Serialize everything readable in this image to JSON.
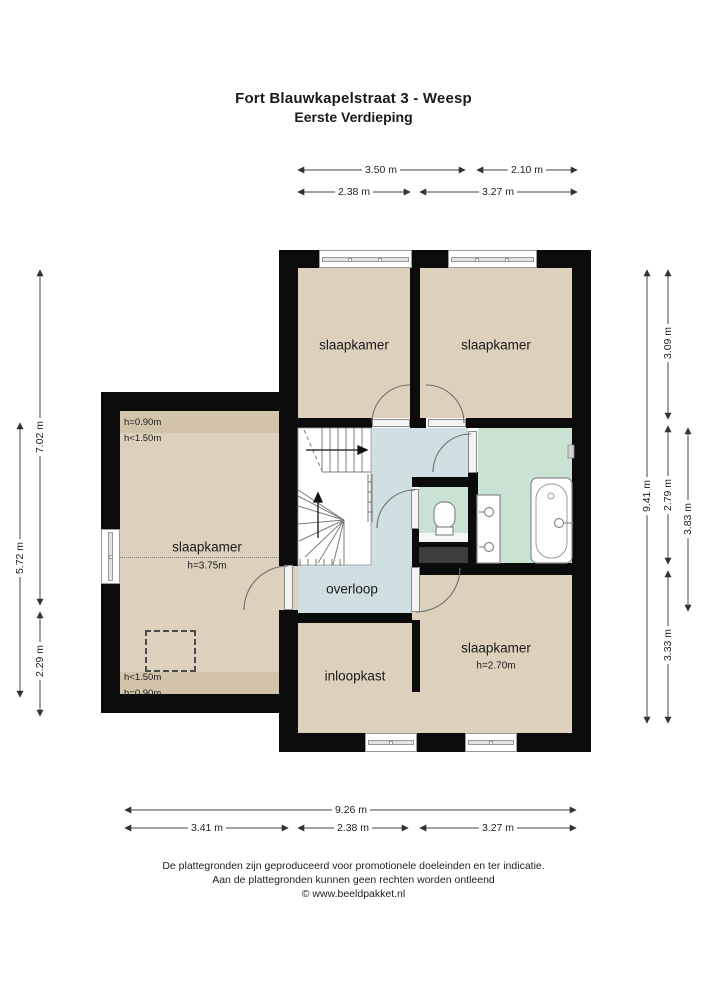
{
  "title": {
    "line1": "Fort Blauwkapelstraat 3 - Weesp",
    "line2": "Eerste Verdieping"
  },
  "rooms": {
    "bedroom_top_left": {
      "label": "slaapkamer"
    },
    "bedroom_top_right": {
      "label": "slaapkamer"
    },
    "bedroom_left_wing": {
      "label": "slaapkamer",
      "ceiling_height": "h=3.75m",
      "edge_heights": [
        "h=0.90m",
        "h<1.50m",
        "h<1.50m",
        "h=0.90m"
      ]
    },
    "bedroom_bottom_right": {
      "label": "slaapkamer",
      "ceiling_height": "h=2.70m"
    },
    "landing": {
      "label": "overloop"
    },
    "closet": {
      "label": "inloopkast"
    }
  },
  "dimensions": {
    "top": [
      "3.50 m",
      "2.10 m",
      "2.38 m",
      "3.27 m"
    ],
    "left": [
      "7.02 m",
      "2.29 m",
      "5.72 m"
    ],
    "right": [
      "9.41 m",
      "3.09 m",
      "2.79 m",
      "3.33 m",
      "3.83 m"
    ],
    "bottom": [
      "9.26 m",
      "3.41 m",
      "2.38 m",
      "3.27 m"
    ]
  },
  "footer": {
    "line1": "De plattegronden zijn geproduceerd voor promotionele doeleinden en ter indicatie.",
    "line2": "Aan de plattegronden kunnen geen rechten worden ontleend",
    "line3": "© www.beeldpakket.nl"
  },
  "colors": {
    "wall": "#0b0b0b",
    "room_tan": "#ddd1bd",
    "room_tan_dark": "#d2c4ab",
    "hall_blue": "#cfdfe2",
    "bath_green": "#c9e2d2",
    "shaft_gray": "#3d3d3d",
    "dim_line": "#444444"
  }
}
